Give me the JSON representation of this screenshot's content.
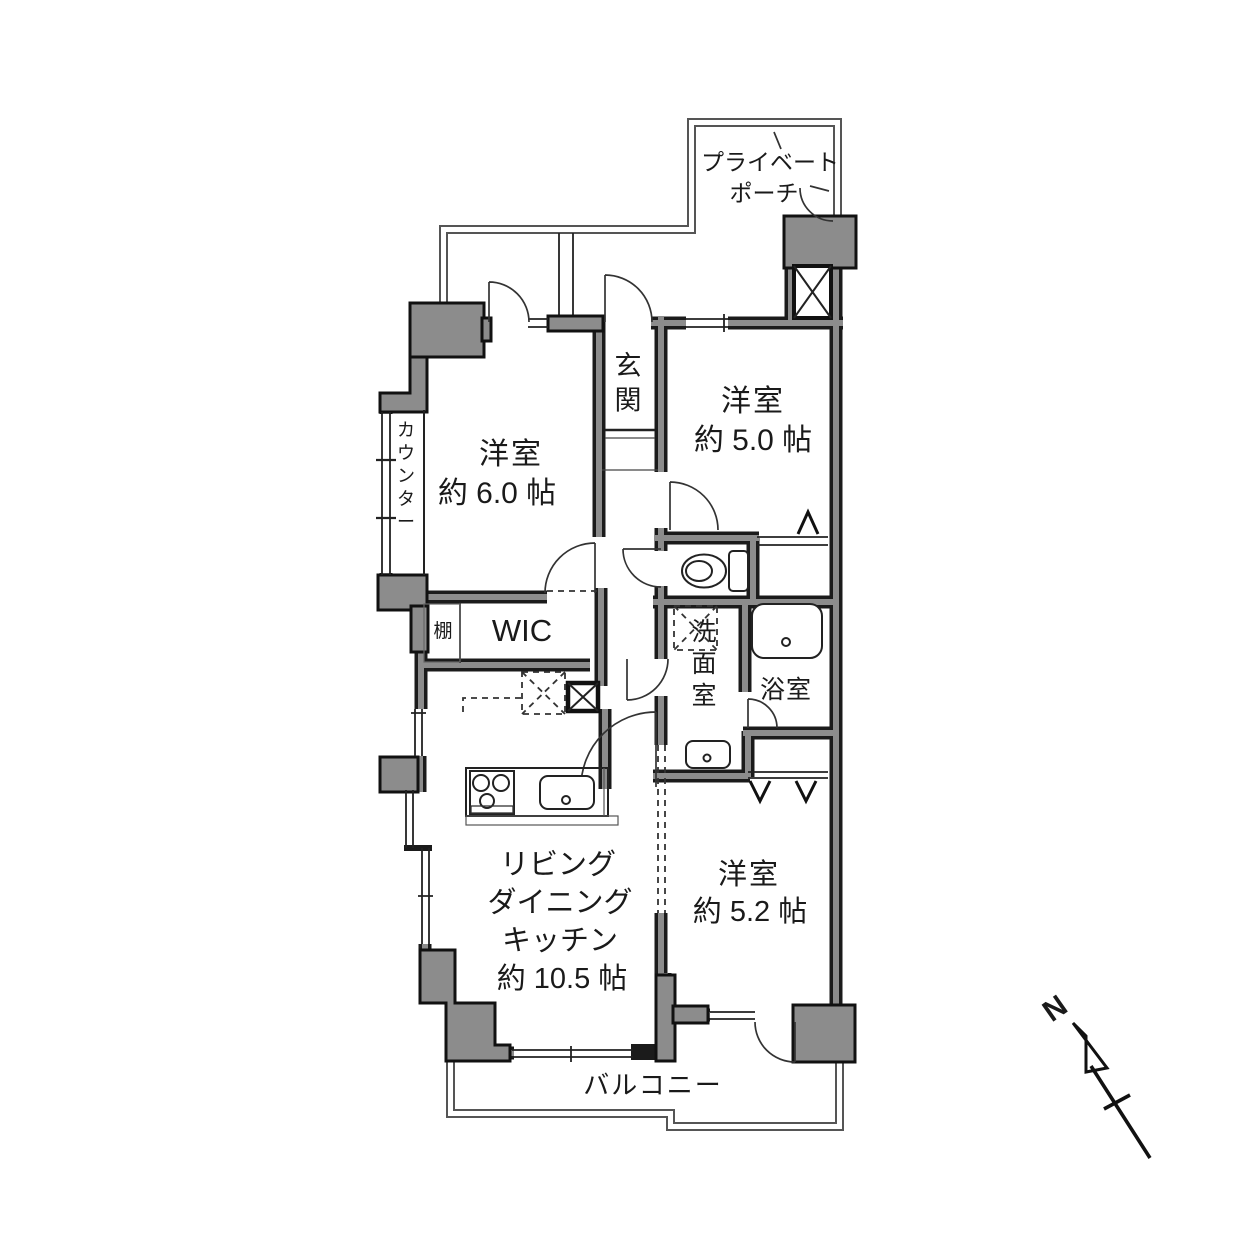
{
  "title": "間取り図",
  "colors": {
    "wall": "#1b1b1b",
    "pillar": "#8c8c8c",
    "outline": "#555555",
    "text": "#1a1a1a",
    "background": "#ffffff"
  },
  "rooms": {
    "bed6": {
      "name": "洋室",
      "size": "約 6.0 帖"
    },
    "bed5": {
      "name": "洋室",
      "size": "約 5.0 帖"
    },
    "bed52": {
      "name": "洋室",
      "size": "約 5.2 帖"
    },
    "ldk": {
      "line1": "リビング",
      "line2": "ダイニング",
      "line3": "キッチン",
      "size": "約 10.5 帖"
    },
    "genkan": {
      "name": "玄関"
    },
    "wic": {
      "name": "WIC"
    },
    "shelf": {
      "name": "棚"
    },
    "washroom": {
      "name": "洗面室"
    },
    "bathroom": {
      "name": "浴室"
    },
    "counter": {
      "name": "カウンター"
    }
  },
  "outdoor": {
    "balcony": "バルコニー",
    "porch_line1": "プライベート",
    "porch_line2": "ポーチ"
  },
  "compass": {
    "north": "N"
  },
  "icons": [
    "toilet-icon",
    "bathtub-icon",
    "washbasin-icon",
    "stove-icon",
    "kitchen-sink-icon",
    "washer-pan-icon",
    "fridge-space-icon",
    "pipe-shaft-icon",
    "north-arrow-icon"
  ]
}
